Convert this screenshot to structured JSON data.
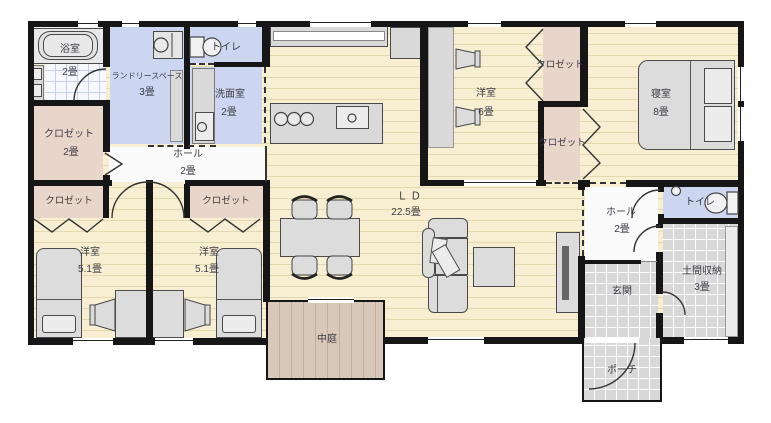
{
  "floorplan": {
    "type": "japanese-house-floor-plan",
    "rooms": [
      {
        "id": "bathroom",
        "label": "浴室",
        "size": "2畳"
      },
      {
        "id": "laundry-space",
        "label": "ランドリースペース",
        "size": "3畳"
      },
      {
        "id": "toilet-top",
        "label": "トイレ",
        "size": ""
      },
      {
        "id": "washroom",
        "label": "洗面室",
        "size": "2畳"
      },
      {
        "id": "closet-main",
        "label": "クロゼット",
        "size": "2畳"
      },
      {
        "id": "hall-left",
        "label": "ホール",
        "size": "2畳"
      },
      {
        "id": "closet-west-1",
        "label": "クロゼット",
        "size": ""
      },
      {
        "id": "closet-west-2",
        "label": "クロゼット",
        "size": ""
      },
      {
        "id": "western-room-1",
        "label": "洋室",
        "size": "5.1畳"
      },
      {
        "id": "western-room-2",
        "label": "洋室",
        "size": "5.1畳"
      },
      {
        "id": "living-dining",
        "label": "Ｌ Ｄ",
        "size": "22.5畳"
      },
      {
        "id": "courtyard",
        "label": "中庭",
        "size": ""
      },
      {
        "id": "western-room-3",
        "label": "洋室",
        "size": "6畳"
      },
      {
        "id": "closet-west3",
        "label": "クロゼット",
        "size": ""
      },
      {
        "id": "closet-bedroom",
        "label": "クロゼット",
        "size": ""
      },
      {
        "id": "bedroom",
        "label": "寝室",
        "size": "8畳"
      },
      {
        "id": "hall-right",
        "label": "ホール",
        "size": "2畳"
      },
      {
        "id": "toilet-right",
        "label": "トイレ",
        "size": ""
      },
      {
        "id": "entrance",
        "label": "玄関",
        "size": ""
      },
      {
        "id": "doma-storage",
        "label": "土間収納",
        "size": "3畳"
      },
      {
        "id": "porch",
        "label": "ポーチ",
        "size": ""
      }
    ],
    "palette": {
      "wall": "#161616",
      "wood_floor": "#f8efd3",
      "wood_line": "#e4d8af",
      "water_room_blue": "#ccd6f1",
      "closet_pink": "#e9d6cb",
      "tile_gray": "#d8d8d8",
      "courtyard_tan": "#d8c8b9",
      "furniture_gray": "#dcdcdc",
      "label_text": "#3c3c46"
    }
  }
}
